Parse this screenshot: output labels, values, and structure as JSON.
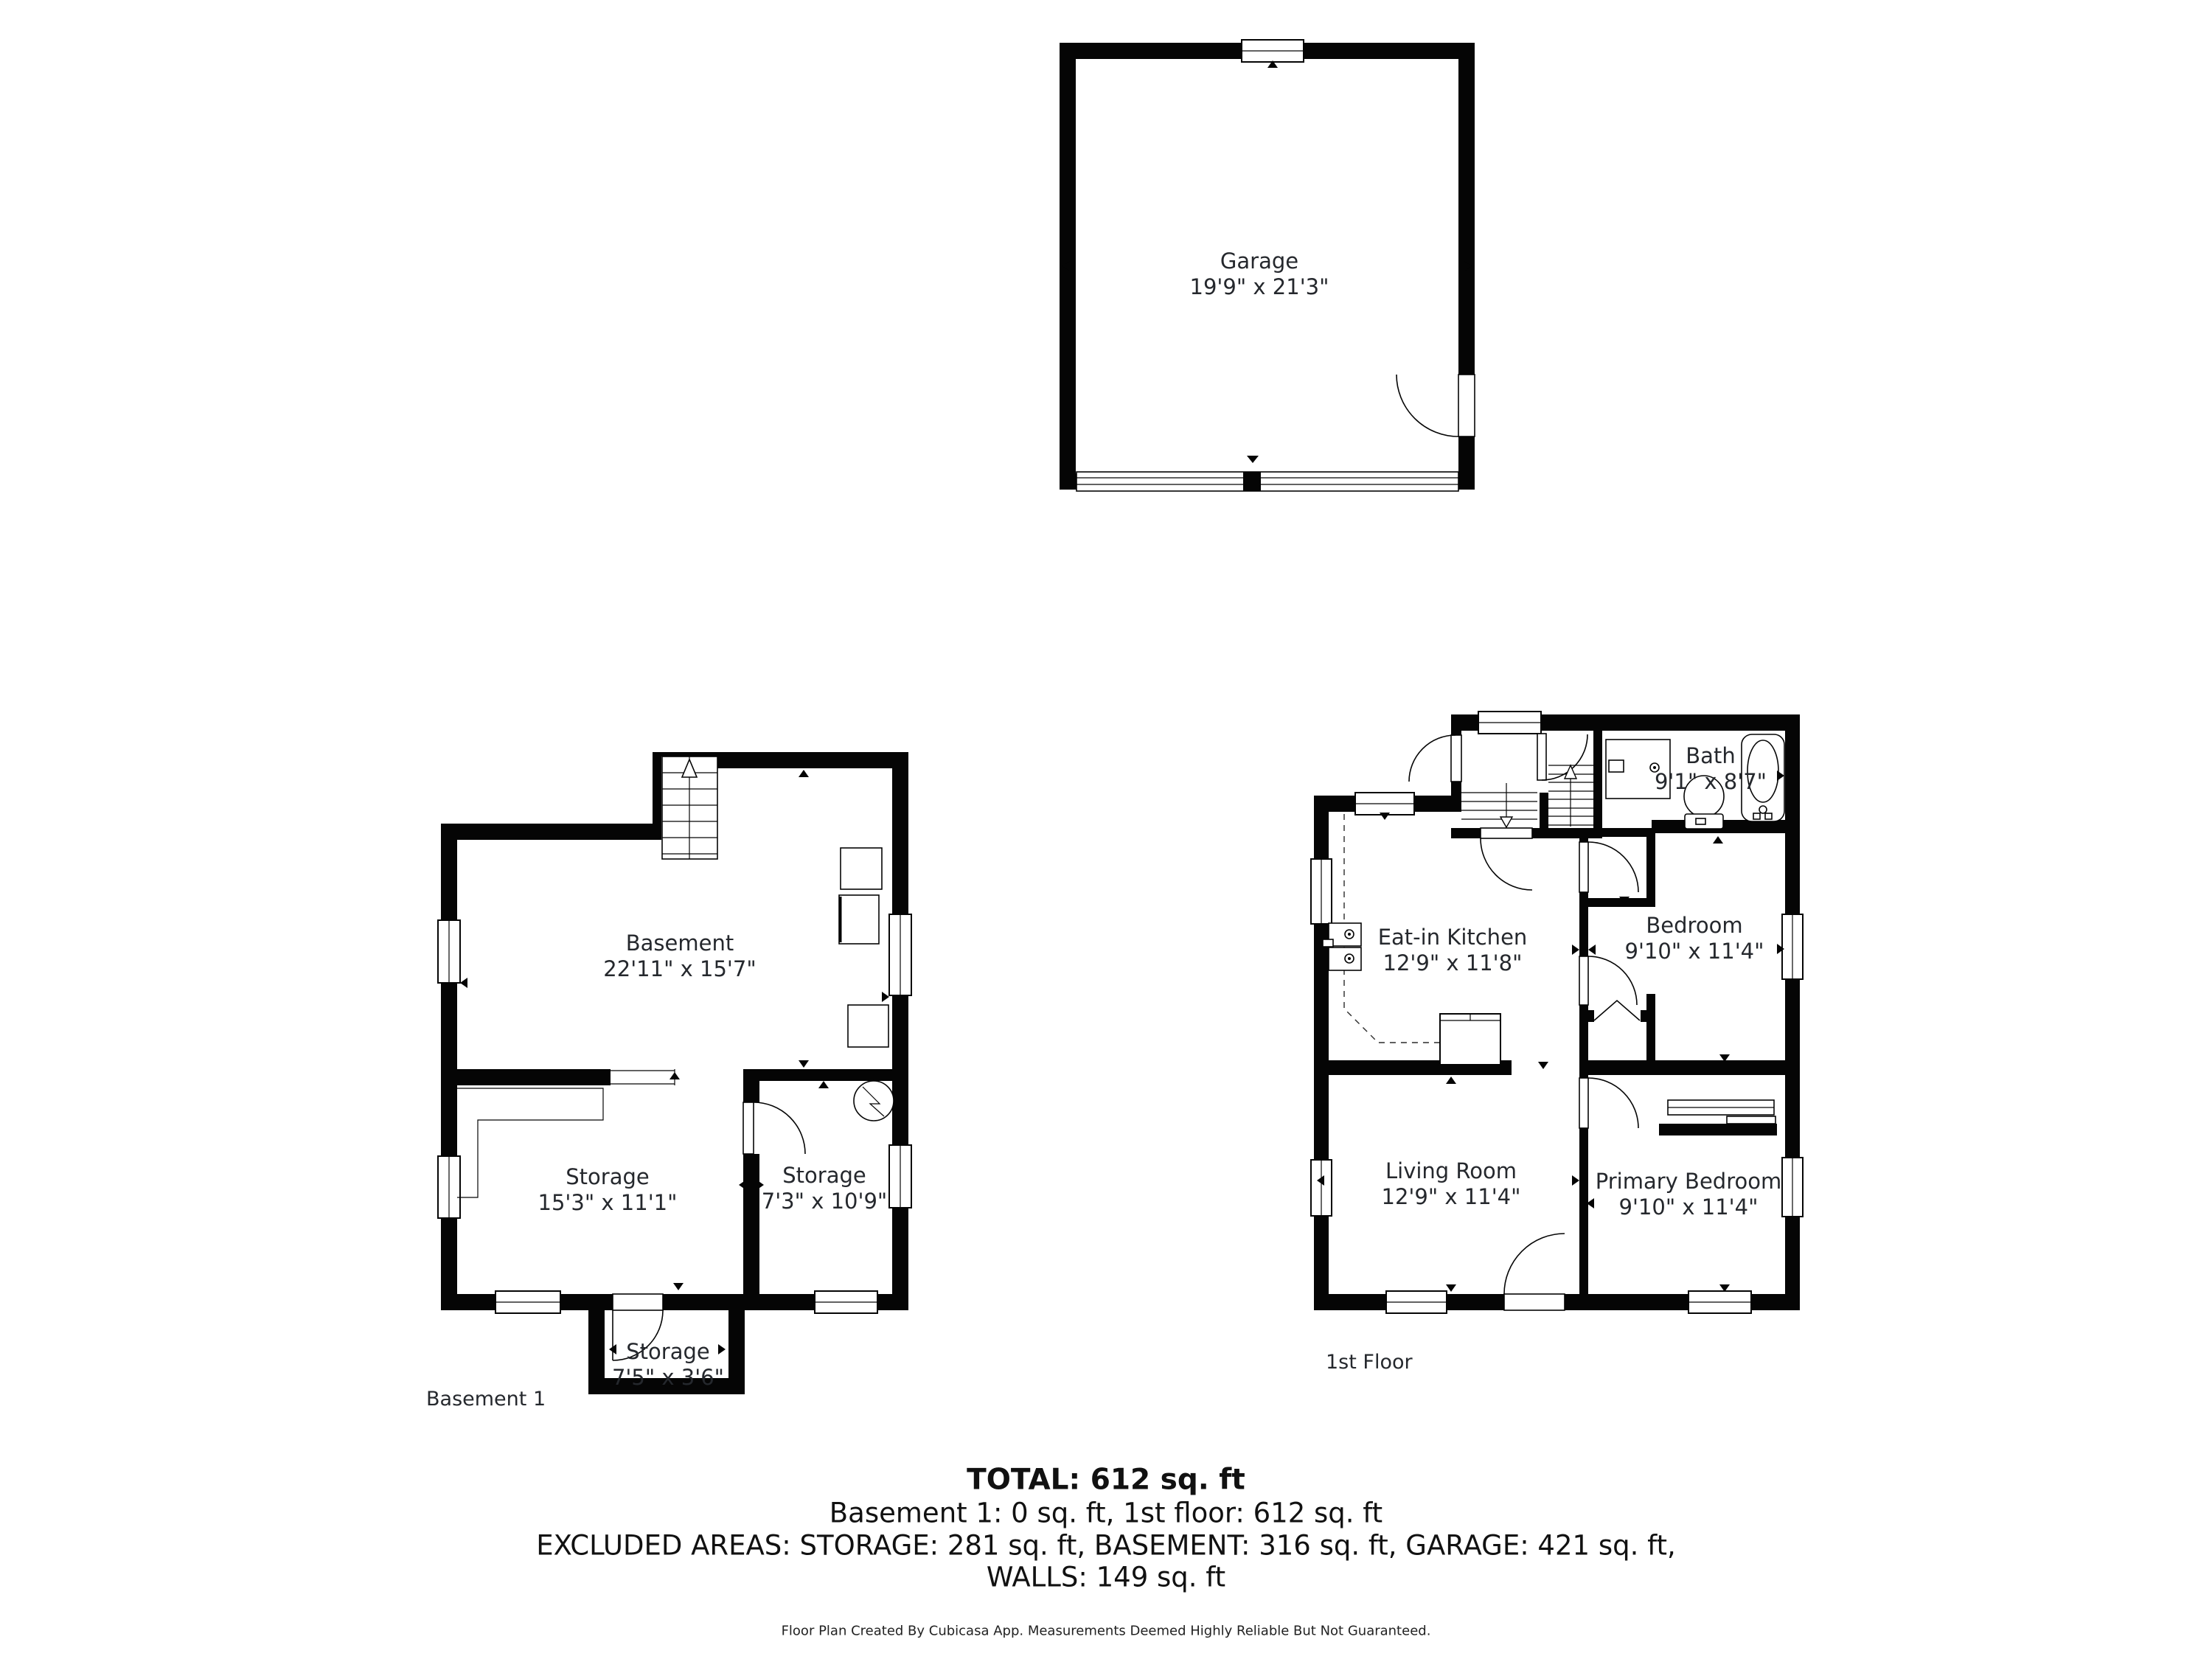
{
  "floors": {
    "garage": {
      "rooms": {
        "garage": {
          "name": "Garage",
          "dims": "19'9\" x 21'3\""
        }
      }
    },
    "basement": {
      "floor_label": "Basement 1",
      "rooms": {
        "main": {
          "name": "Basement",
          "dims": "22'11\" x 15'7\""
        },
        "storage_a": {
          "name": "Storage",
          "dims": "15'3\" x 11'1\""
        },
        "storage_b": {
          "name": "Storage",
          "dims": "7'3\" x 10'9\""
        },
        "storage_c": {
          "name": "Storage",
          "dims": "7'5\" x 3'6\""
        }
      }
    },
    "first_floor": {
      "floor_label": "1st Floor",
      "rooms": {
        "kitchen": {
          "name": "Eat-in Kitchen",
          "dims": "12'9\" x 11'8\""
        },
        "bath": {
          "name": "Bath",
          "dims": "9'1\" x 8'7\""
        },
        "bedroom": {
          "name": "Bedroom",
          "dims": "9'10\" x 11'4\""
        },
        "living": {
          "name": "Living Room",
          "dims": "12'9\" x 11'4\""
        },
        "primary": {
          "name": "Primary Bedroom",
          "dims": "9'10\" x 11'4\""
        }
      }
    }
  },
  "summary": {
    "total_line": "TOTAL: 612 sq. ft",
    "floors_line": "Basement 1: 0 sq. ft, 1st floor: 612 sq. ft",
    "excluded_line": "EXCLUDED AREAS: STORAGE: 281 sq. ft, BASEMENT: 316 sq. ft, GARAGE: 421 sq. ft,",
    "walls_line": "WALLS: 149 sq. ft"
  },
  "attribution": "Floor Plan Created By Cubicasa App. Measurements Deemed Highly Reliable But Not Guaranteed.",
  "colors": {
    "wall": "#050505",
    "background": "#ffffff",
    "text": "#25282d"
  }
}
